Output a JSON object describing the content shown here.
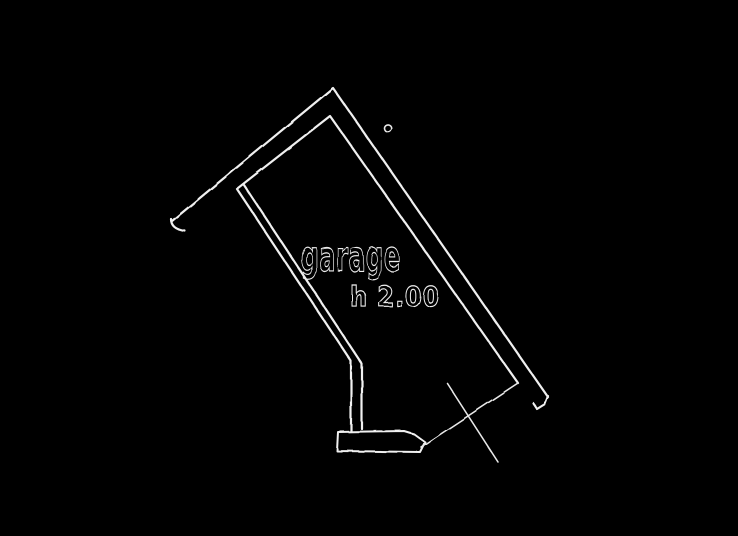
{
  "drawing": {
    "background_color": "#000000",
    "line_color": "#f0f0f0",
    "labels": {
      "room_name": "garage",
      "height_note": "h 2.00"
    },
    "paths": {
      "outer_wall": "M172,221 L333,88 L548,397",
      "outer_wall_left_cap": "M171,219 Q171,229 185,231",
      "outer_wall_right_cap": "M548,396 L545,404 L537,409 L533,403",
      "inner_wall": "M238,188 L330,116 L518,383",
      "interior_wall_outer_face": "M237,189 L351,361 L351,433",
      "interior_wall_inner_face": "M244,185 L362,364 L362,429",
      "threshold_step": "M338,432 L404,431 L414,434 L425,442 L420,452 L337,451 Z",
      "door_leaf": "M421,447 L518,383",
      "door_swing_cross": "M447,383 L498,462",
      "marker_dot": "M384,128 a3.6,3.6 0 1 0 7.2,0 a3.6,3.6 0 1 0 -7.2,0"
    }
  }
}
